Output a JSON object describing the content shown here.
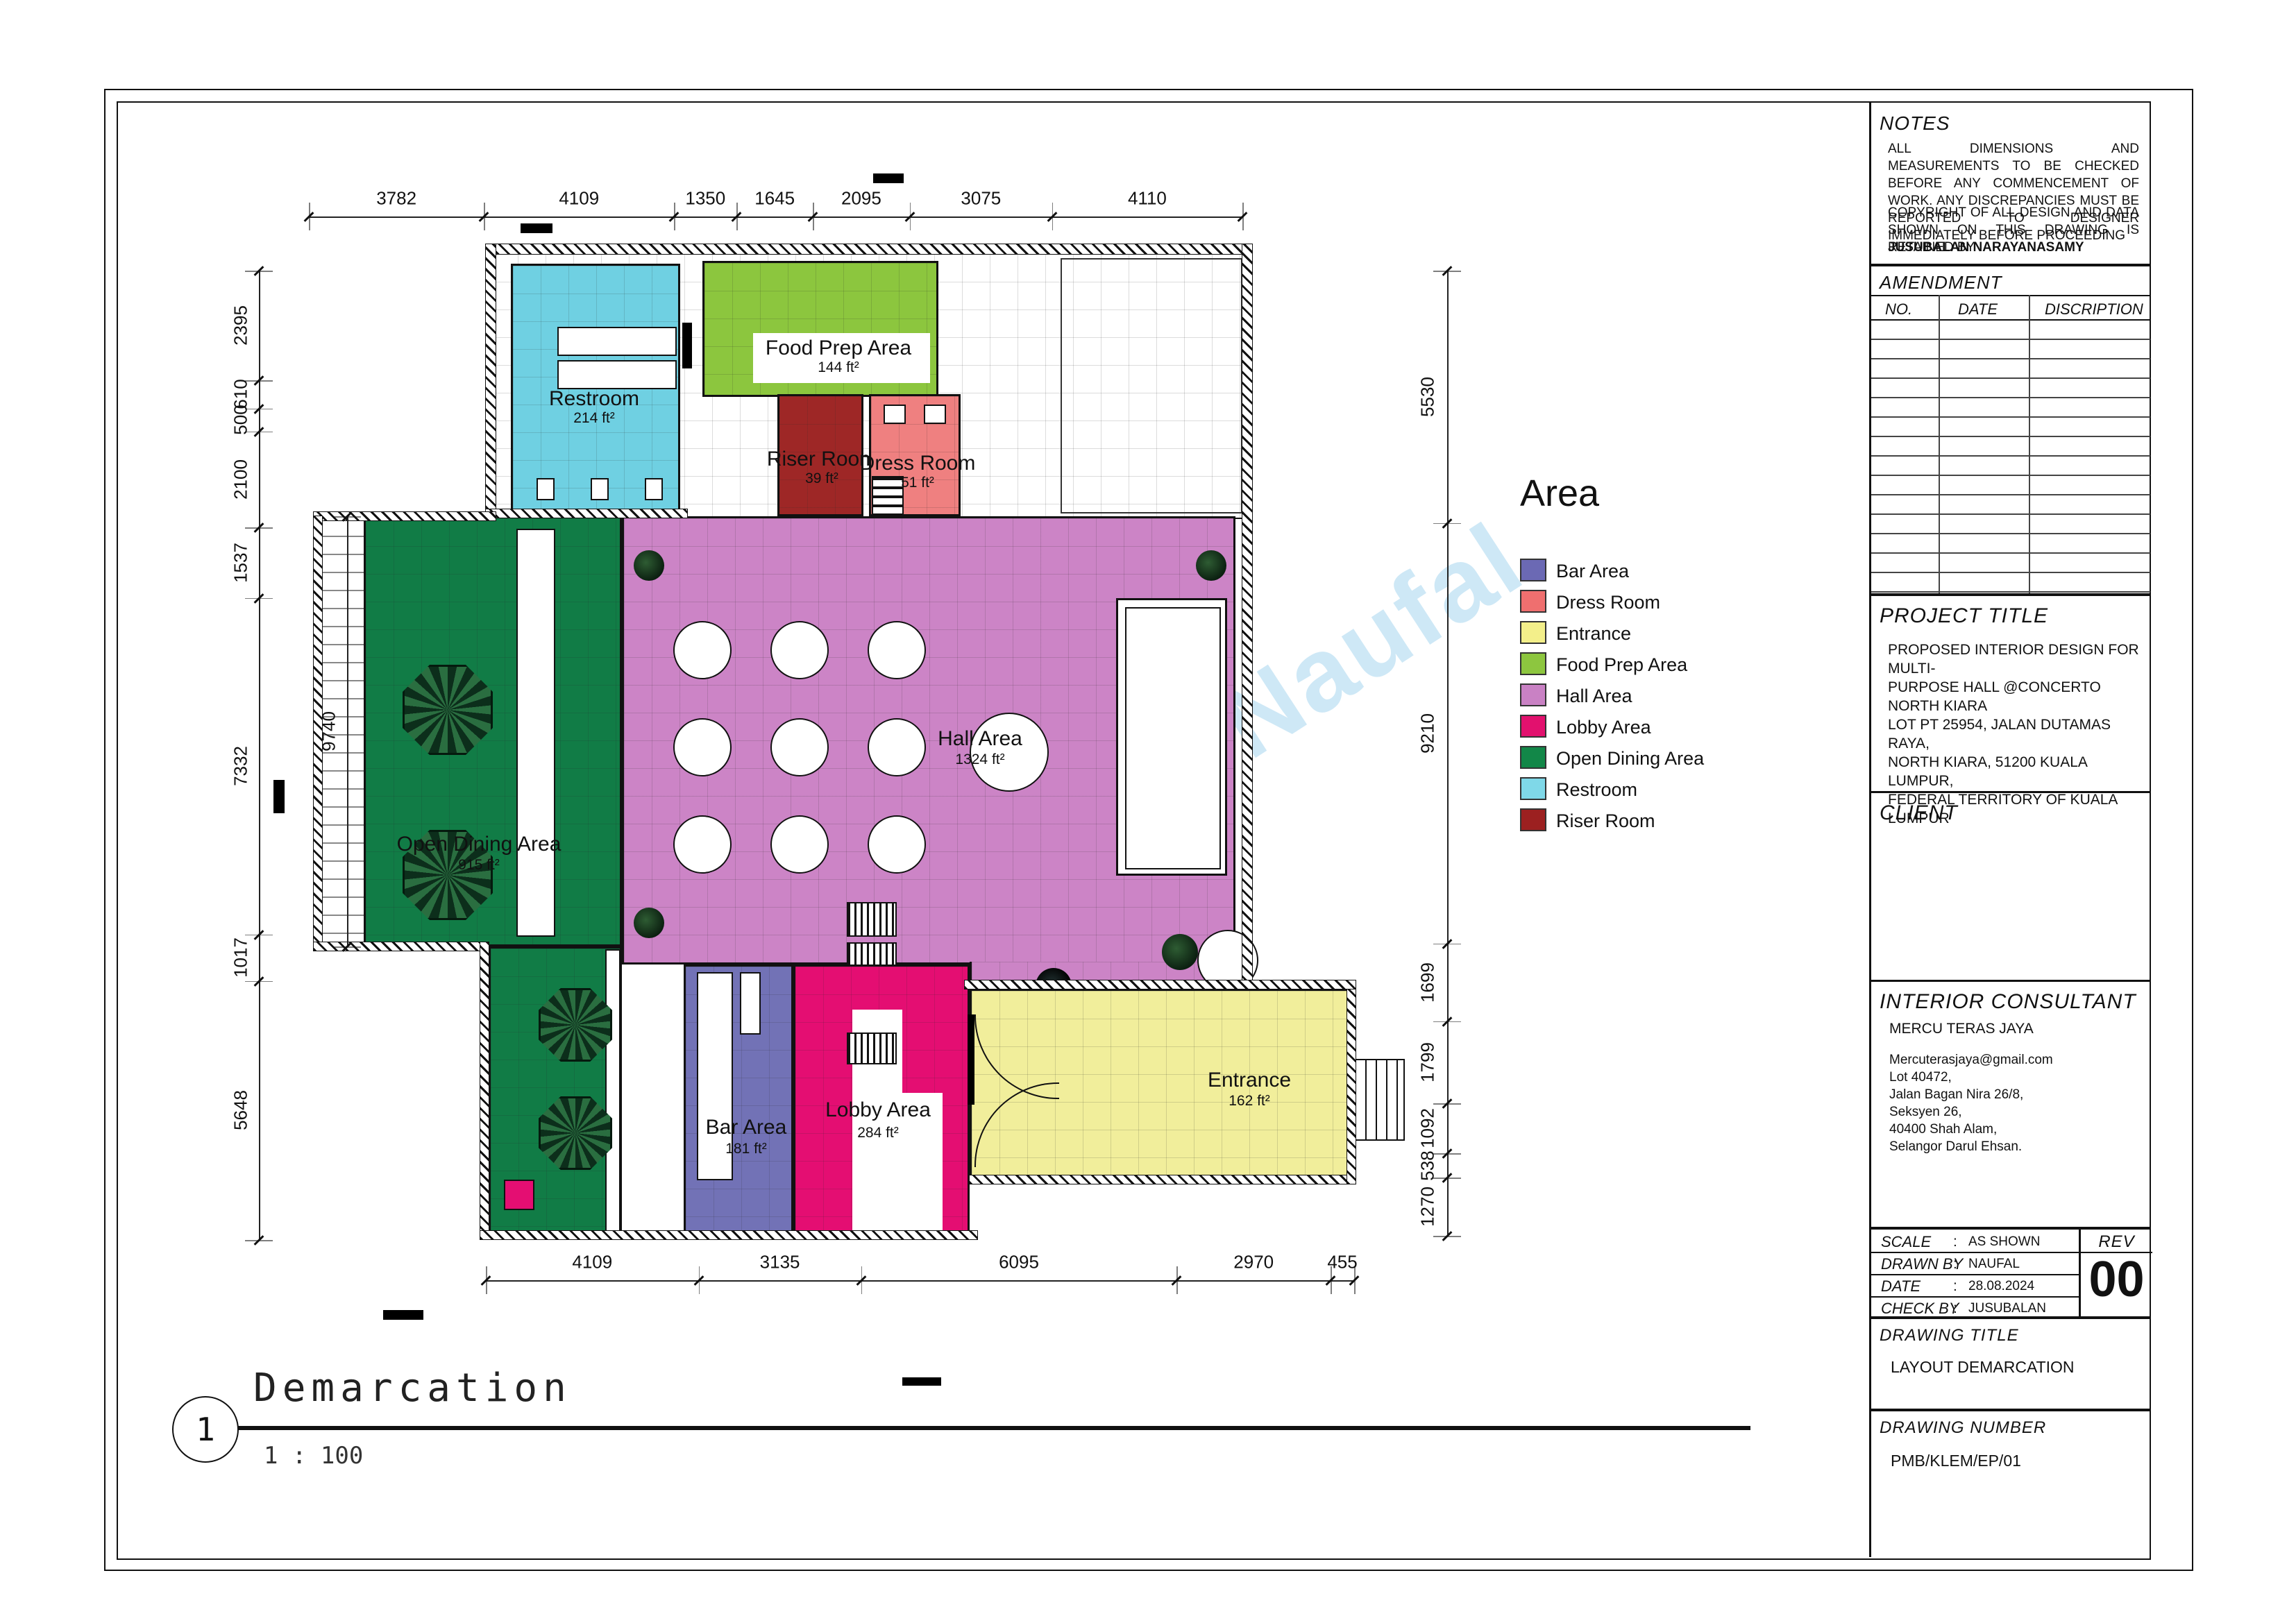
{
  "watermark": "BlueprintByNaufal",
  "view": {
    "number": "1",
    "name": "Demarcation",
    "scale": "1 : 100"
  },
  "legend": {
    "title": "Area",
    "items": [
      {
        "label": "Bar Area",
        "color": "#6b69b4"
      },
      {
        "label": "Dress Room",
        "color": "#ef6f6f"
      },
      {
        "label": "Entrance",
        "color": "#f3ef8a"
      },
      {
        "label": "Food Prep Area",
        "color": "#8dc63f"
      },
      {
        "label": "Hall Area",
        "color": "#c981c4"
      },
      {
        "label": "Lobby Area",
        "color": "#e2116e"
      },
      {
        "label": "Open Dining Area",
        "color": "#128748"
      },
      {
        "label": "Restroom",
        "color": "#7fd8e8"
      },
      {
        "label": "Riser Room",
        "color": "#9c2020"
      }
    ]
  },
  "rooms": [
    {
      "name": "Restroom",
      "area": "214 ft²",
      "color": "#6fd0e2"
    },
    {
      "name": "Food Prep Area",
      "area": "144 ft²",
      "color": "#8cc63e"
    },
    {
      "name": "Riser Room",
      "area": "39 ft²",
      "color": "#9e2726"
    },
    {
      "name": "Dress Room",
      "area": "51 ft²",
      "color": "#ef8080"
    },
    {
      "name": "Hall Area",
      "area": "1324 ft²",
      "color": "#cc84c6"
    },
    {
      "name": "Open Dining Area",
      "area": "915 ft²",
      "color": "#117c46"
    },
    {
      "name": "Bar Area",
      "area": "181 ft²",
      "color": "#7272b6"
    },
    {
      "name": "Lobby Area",
      "area": "284 ft²",
      "color": "#e40e72"
    },
    {
      "name": "Entrance",
      "area": "162 ft²",
      "color": "#f1ee9b"
    }
  ],
  "dimensions": {
    "top": [
      "3782",
      "4109",
      "1350",
      "1645",
      "2095",
      "3075",
      "4110"
    ],
    "bottom": [
      "4109",
      "3135",
      "6095",
      "2970",
      "455"
    ],
    "left": [
      "2395",
      "610",
      "500",
      "2100",
      "1537",
      "7332",
      "1017",
      "5648"
    ],
    "right": [
      "5530",
      "9210",
      "1699",
      "1799",
      "1092",
      "538",
      "1270"
    ],
    "inner": [
      "9740"
    ]
  },
  "title_block": {
    "notes": {
      "label": "NOTES",
      "para1": "ALL DIMENSIONS AND MEASUREMENTS TO BE CHECKED BEFORE ANY COMMENCEMENT OF WORK. ANY DISCREPANCIES MUST BE REPORTED TO DESIGNER IMMEDIATELY BEFORE PROCEEDING",
      "para2": "COPYRIGHT OF ALL DESIGN AND DATA SHOWN ON THIS DRAWING IS RETAINED BY",
      "copyright_name": "JUSUBALAN NARAYANASAMY"
    },
    "amendment": {
      "label": "AMENDMENT",
      "columns": [
        "NO.",
        "DATE",
        "DISCRIPTION"
      ]
    },
    "project_title": {
      "label": "PROJECT TITLE",
      "lines": [
        "PROPOSED INTERIOR DESIGN FOR MULTI-",
        "PURPOSE HALL @CONCERTO NORTH KIARA",
        "LOT PT 25954, JALAN DUTAMAS RAYA,",
        "NORTH KIARA, 51200 KUALA LUMPUR,",
        "FEDERAL TERRITORY OF KUALA LUMPUR"
      ]
    },
    "client": {
      "label": "CLIENT"
    },
    "consultant": {
      "label": "INTERIOR CONSULTANT",
      "name": "MERCU TERAS JAYA",
      "address": [
        "Mercuterasjaya@gmail.com",
        "Lot 40472,",
        "Jalan Bagan Nira 26/8,",
        "Seksyen 26,",
        "40400 Shah Alam,",
        "Selangor Darul Ehsan."
      ]
    },
    "meta": {
      "colon": ":",
      "scale_label": "SCALE",
      "scale_value": "AS SHOWN",
      "drawn_label": "DRAWN BY",
      "drawn_value": "NAUFAL",
      "date_label": "DATE",
      "date_value": "28.08.2024",
      "check_label": "CHECK BY",
      "check_value": "JUSUBALAN",
      "rev_label": "REV",
      "rev_value": "00"
    },
    "drawing_title": {
      "label": "DRAWING TITLE",
      "value": "LAYOUT DEMARCATION"
    },
    "drawing_number": {
      "label": "DRAWING NUMBER",
      "value": "PMB/KLEM/EP/01"
    }
  }
}
